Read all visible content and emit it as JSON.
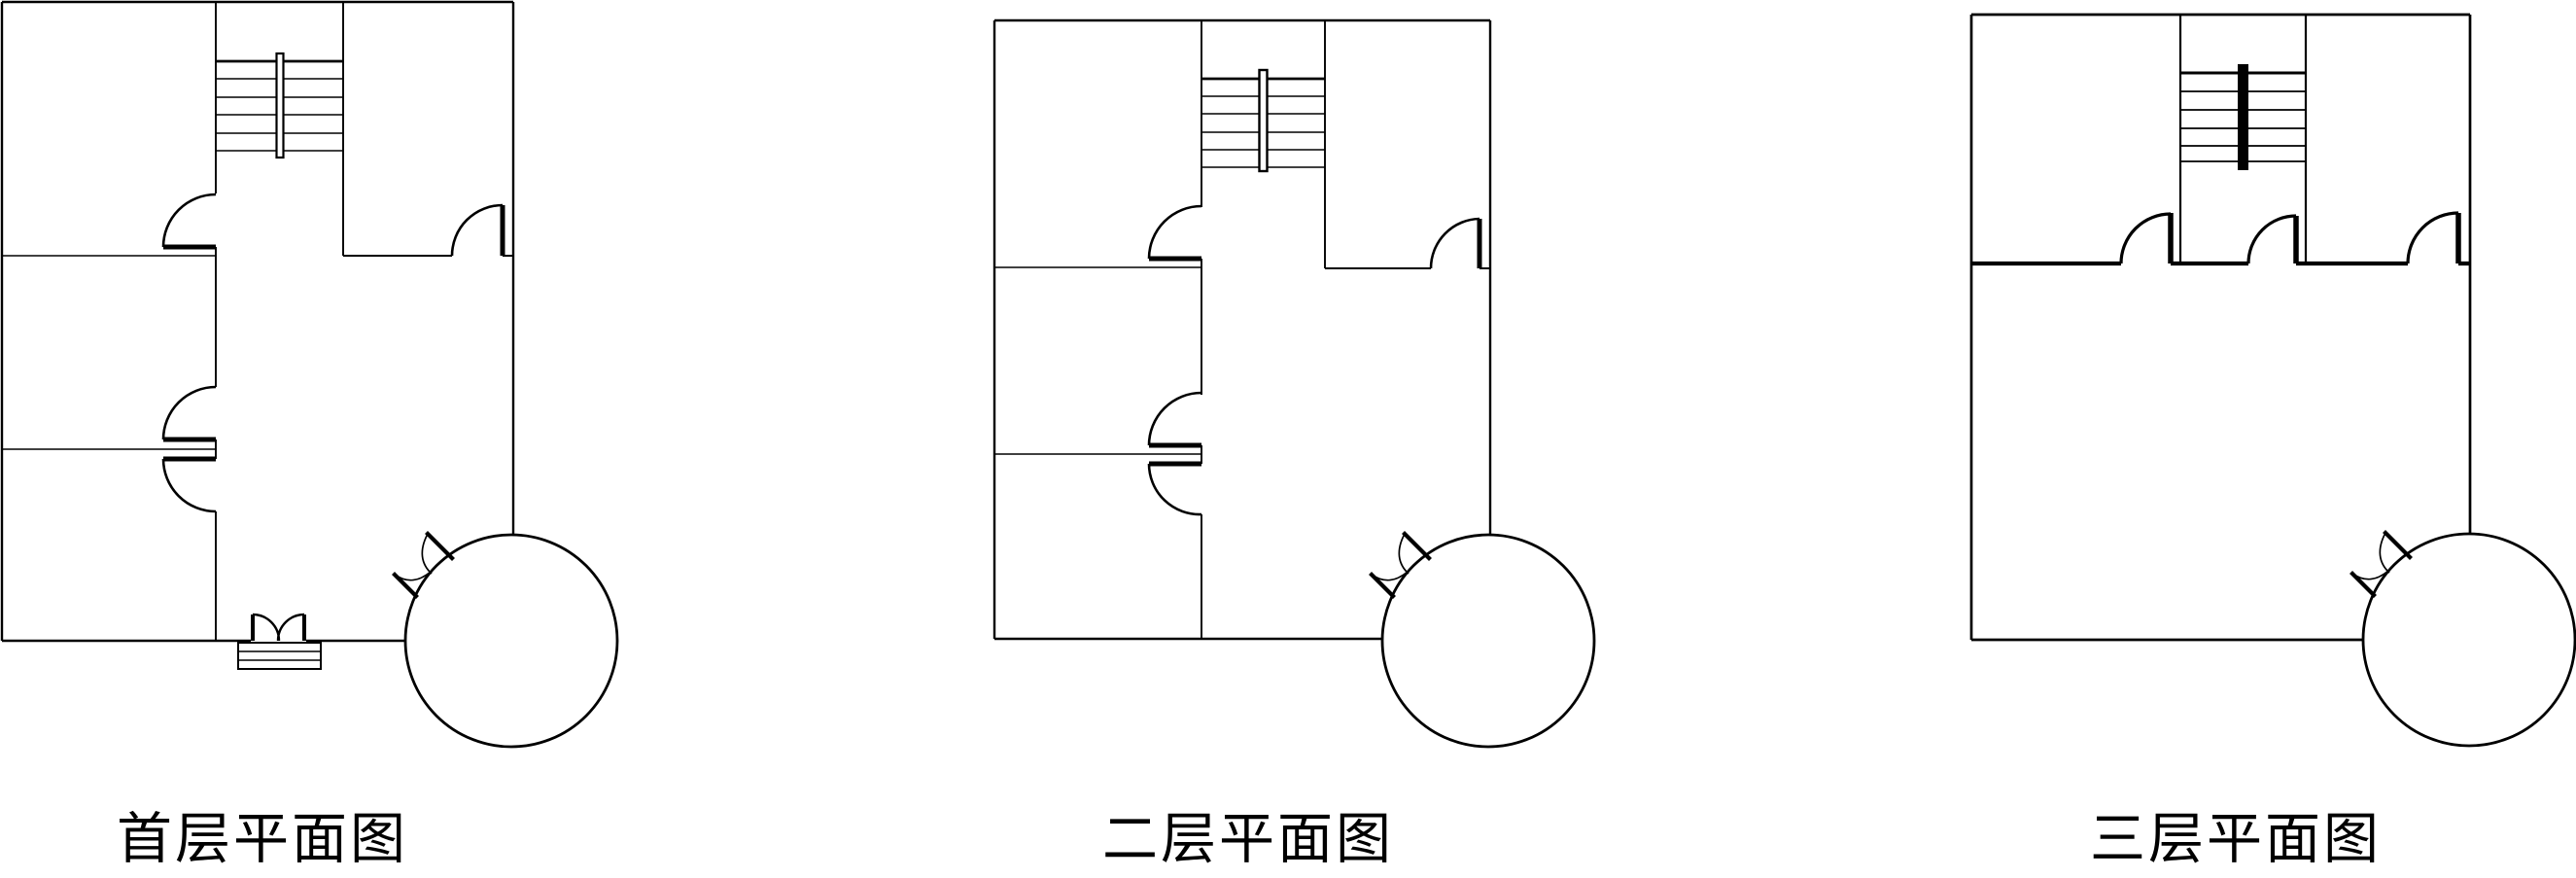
{
  "page": {
    "background_color": "#ffffff",
    "line_color": "#000000",
    "kind": "architectural floor plan drawing, 3 plans side by side"
  },
  "plans": [
    {
      "title": "首层平面图",
      "stair_treads": 6,
      "door_arcs": 4,
      "entrance": "double swing door with 3 steps at bottom wall",
      "tree_symbol": "circle with two leaf spikes at bottom-right corner",
      "rooms_left_column": 3
    },
    {
      "title": "二层平面图",
      "stair_treads": 6,
      "door_arcs": 4,
      "entrance": "none (solid bottom wall)",
      "tree_symbol": "circle with two leaf spikes at bottom-right corner",
      "rooms_left_column": 3
    },
    {
      "title": "三层平面图",
      "stair_treads": 6,
      "door_arcs": 3,
      "entrance": "none (solid bottom wall)",
      "tree_symbol": "circle with two leaf spikes at bottom-right corner",
      "rooms_left_column": 1
    }
  ]
}
